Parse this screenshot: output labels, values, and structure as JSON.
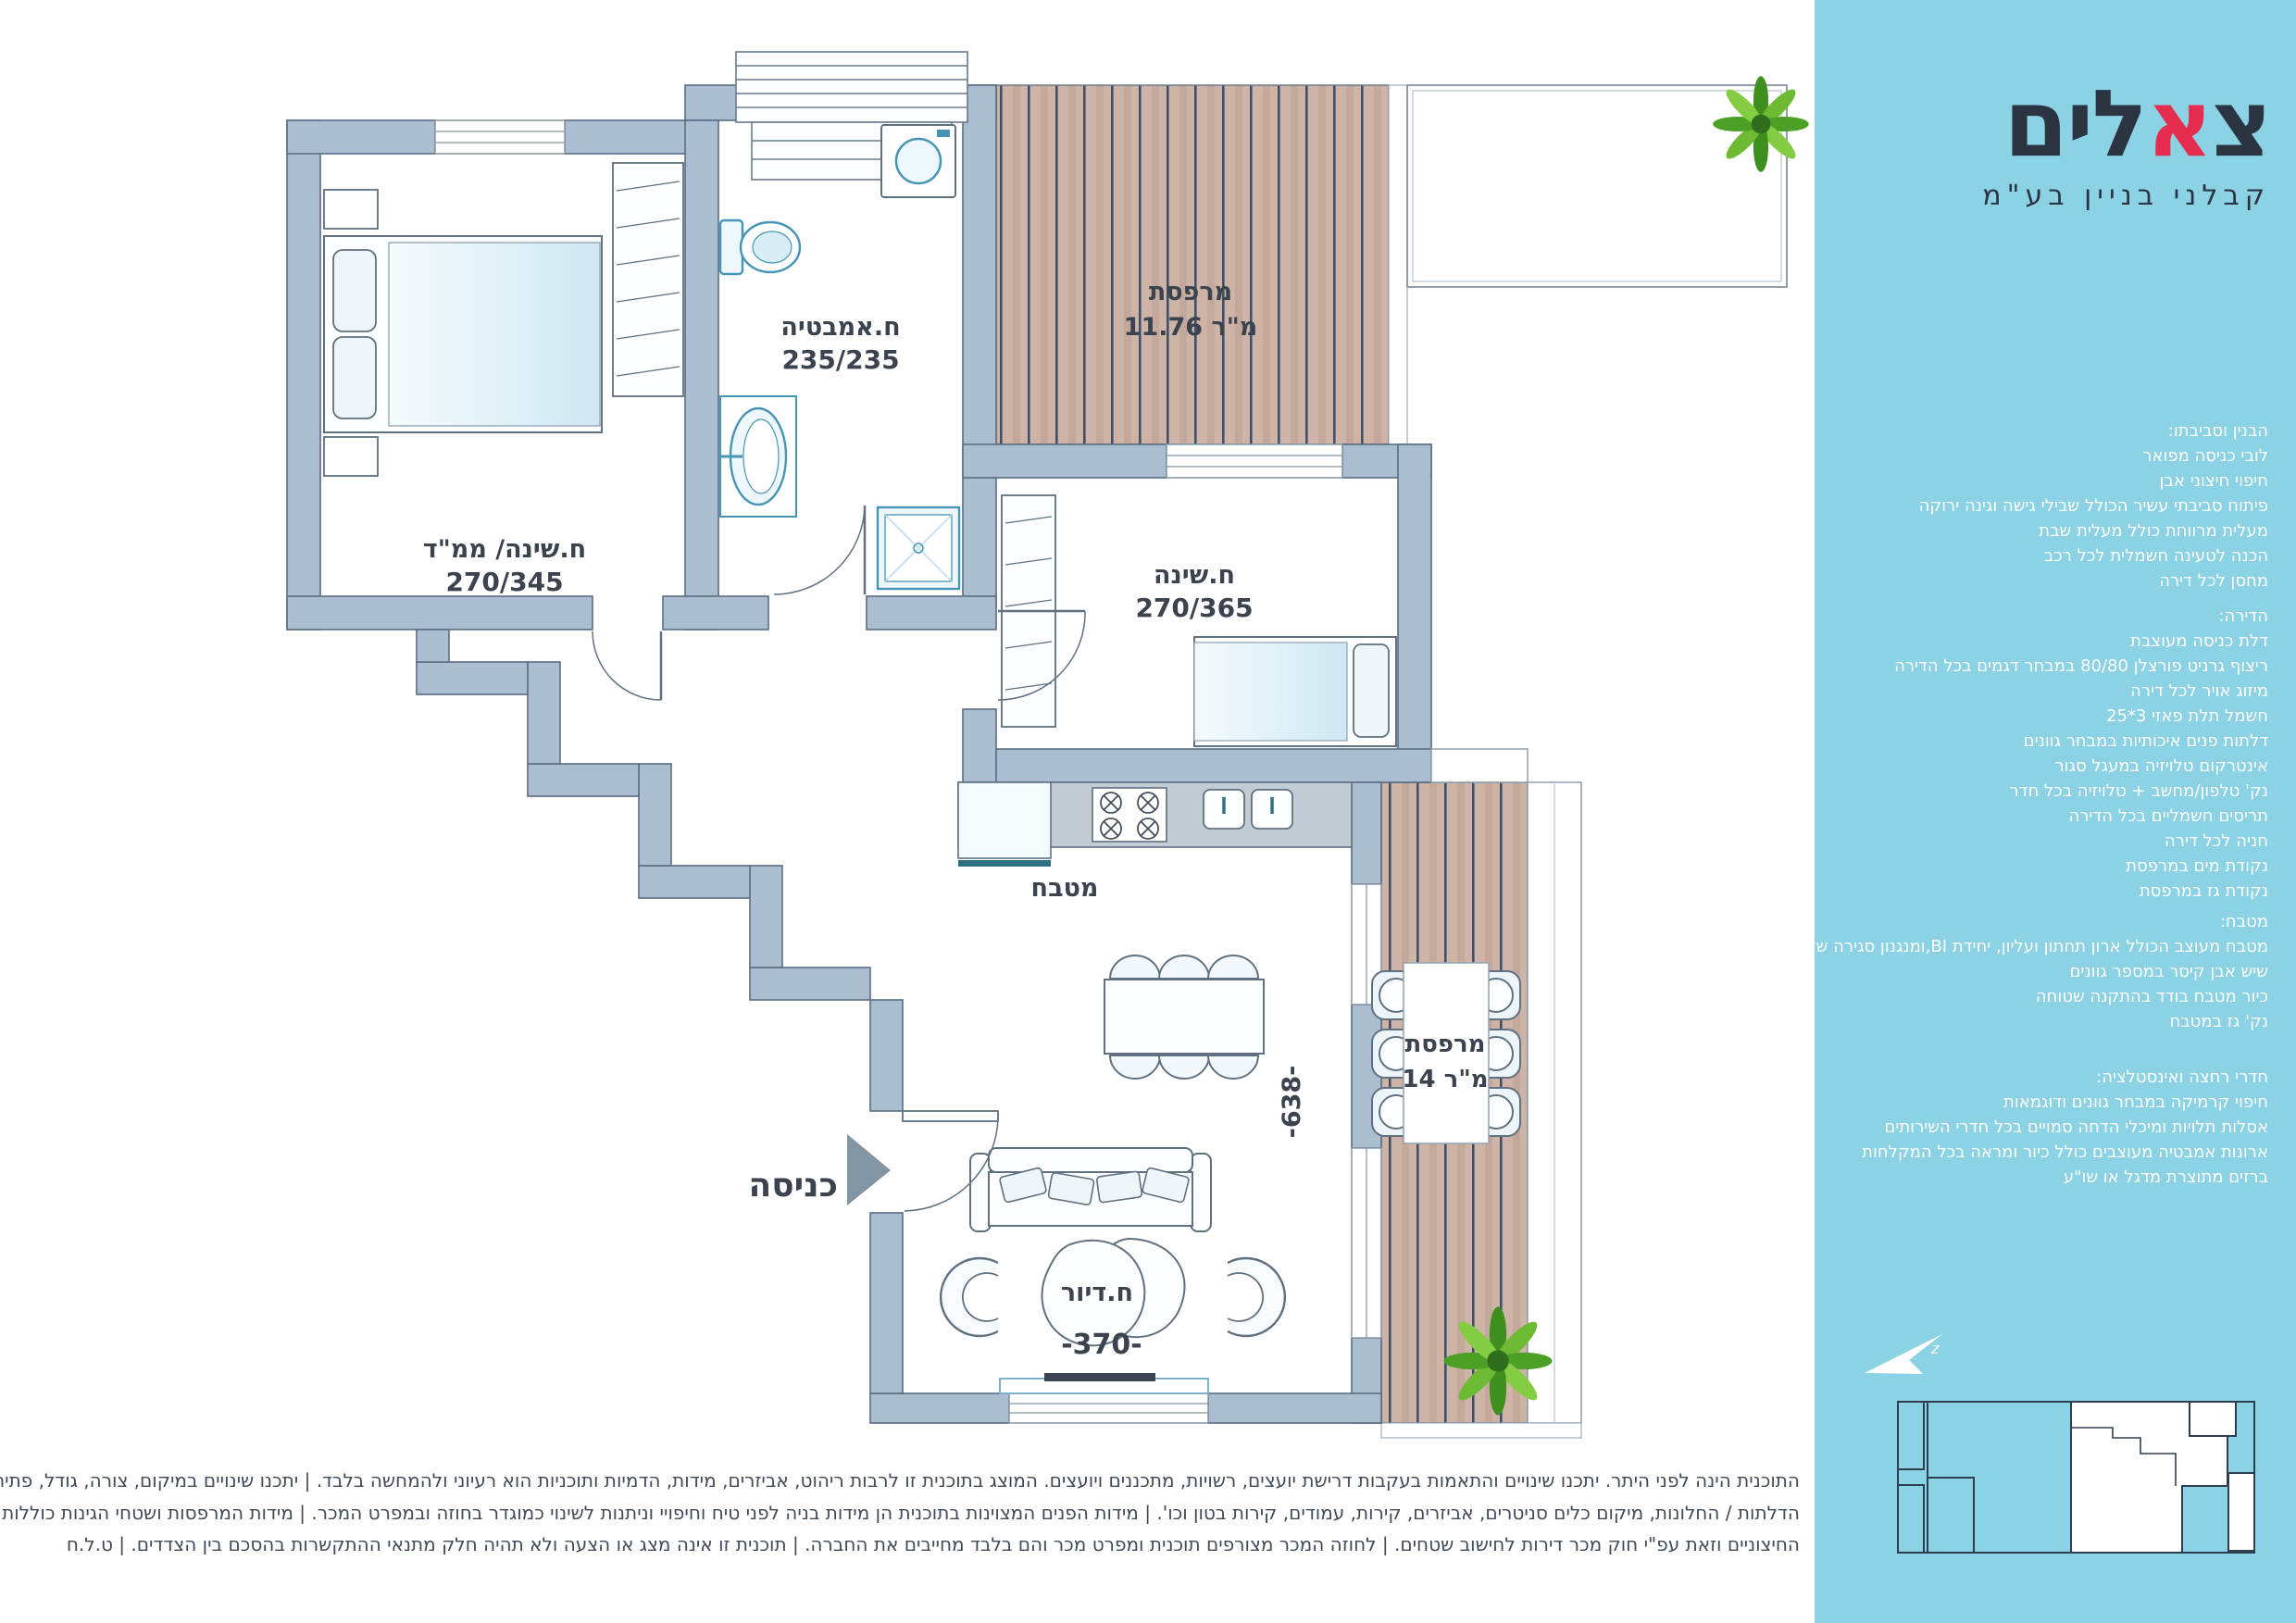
{
  "colors": {
    "sidebar_bg": "#8bd2e4",
    "logo_navy": "#2b3542",
    "logo_red": "#e62d50",
    "wall": "#aabdd1",
    "deck_wood": "#cdb4a7",
    "fixture_teal": "#4695b5",
    "text_dark": "#3b434e"
  },
  "sidebar": {
    "logo": {
      "pre": "צ",
      "red": "א",
      "post": "לים",
      "subtitle": "קבלני בניין בע\"מ"
    },
    "north_mark": "z",
    "sections": [
      {
        "title": "הבנין וסביבתו:",
        "lines": [
          "לובי כניסה מפואר",
          "חיפוי חיצוני אבן",
          "פיתוח סביבתי עשיר הכולל שבילי גישה וגינה ירוקה",
          "מעלית מרווחת כולל מעלית שבת",
          "הכנה לטעינה חשמלית לכל רכב",
          "מחסן לכל דירה"
        ]
      },
      {
        "title": "הדירה:",
        "lines": [
          "דלת כניסה מעוצבת",
          "ריצוף גרניט פורצלן 80/80 במבחר דגמים בכל הדירה",
          "מיזוג אויר לכל דירה",
          "חשמל תלת פאזי 3*25",
          "דלתות פנים איכותיות במבחר גוונים",
          "אינטרקום טלויזיה במעגל סגור",
          "נק' טלפון/מחשב + טלויזיה בכל חדר",
          "תריסים חשמליים בכל הדירה",
          "חניה לכל דירה",
          "נקודת מים במרפסת",
          "נקודת גז במרפסת"
        ]
      },
      {
        "title": "מטבח:",
        "lines": [
          "מטבח מעוצב הכולל ארון תחתון ועליון, יחידת BI,ומנגנון סגירה שקטה",
          "שיש אבן קיסר במספר גוונים",
          "כיור מטבח בודד בהתקנה שטוחה",
          "נק' גז במטבח"
        ]
      },
      {
        "title": "חדרי רחצה ואינסטלציה:",
        "lines": [
          "חיפוי קרמיקה במבחר גוונים ודוגמאות",
          "אסלות תלויות ומיכלי הדחה סמויים בכל חדרי השירותים",
          "ארונות אמבטיה מעוצבים כולל כיור ומראה בכל המקלחות",
          "ברזים מתוצרת מדגל או שו\"ע"
        ]
      }
    ]
  },
  "plan": {
    "rooms": {
      "bedroom1": {
        "name": "ח.שינה/ ממ\"ד",
        "dims": "270/345"
      },
      "bathroom": {
        "name": "ח.אמבטיה",
        "dims": "235/235"
      },
      "balcony_top": {
        "name": "מרפסת",
        "area": "11.76 מ\"ר"
      },
      "bedroom2": {
        "name": "ח.שינה",
        "dims": "270/365"
      },
      "kitchen": {
        "name": "מטבח"
      },
      "entrance": {
        "name": "כניסה"
      },
      "living": {
        "name": "ח.דיור"
      },
      "balcony_side": {
        "name": "מרפסת",
        "area": "14 מ\"ר"
      }
    },
    "dims": {
      "living_width": "-370-",
      "balcony_depth": "-638-"
    }
  },
  "disclaimer": {
    "line1": "התוכנית הינה לפני היתר. יתכנו שינויים והתאמות בעקבות דרישת יועצים, רשויות, מתכננים ויועצים. המוצג בתוכנית זו לרבות ריהוט, אביזרים, מידות, הדמיות ותוכניות הוא רעיוני ולהמחשה בלבד. | יתכנו שינויים במיקום, צורה, גודל, פתיחה וחלוקת של",
    "line2": "הדלתות / החלונות, מיקום כלים סניטרים, אביזרים, קירות, עמודים, קירות בטון וכו'. | מידות הפנים המצוינות בתוכנית הן מידות בניה לפני טיח וחיפויי וניתנות לשינוי כמוגדר בחוזה ובמפרט המכר. | מידות המרפסות ושטחי הגינות כוללות את המעקות",
    "line3": "החיצוניים וזאת עפ\"י חוק מכר דירות לחישוב שטחים. | לחוזה המכר מצורפים תוכנית ומפרט מכר והם בלבד מחייבים את החברה. | תוכנית זו אינה מצג או הצעה ולא תהיה חלק מתנאי ההתקשרות בהסכם בין הצדדים. | ט.ל.ח"
  }
}
